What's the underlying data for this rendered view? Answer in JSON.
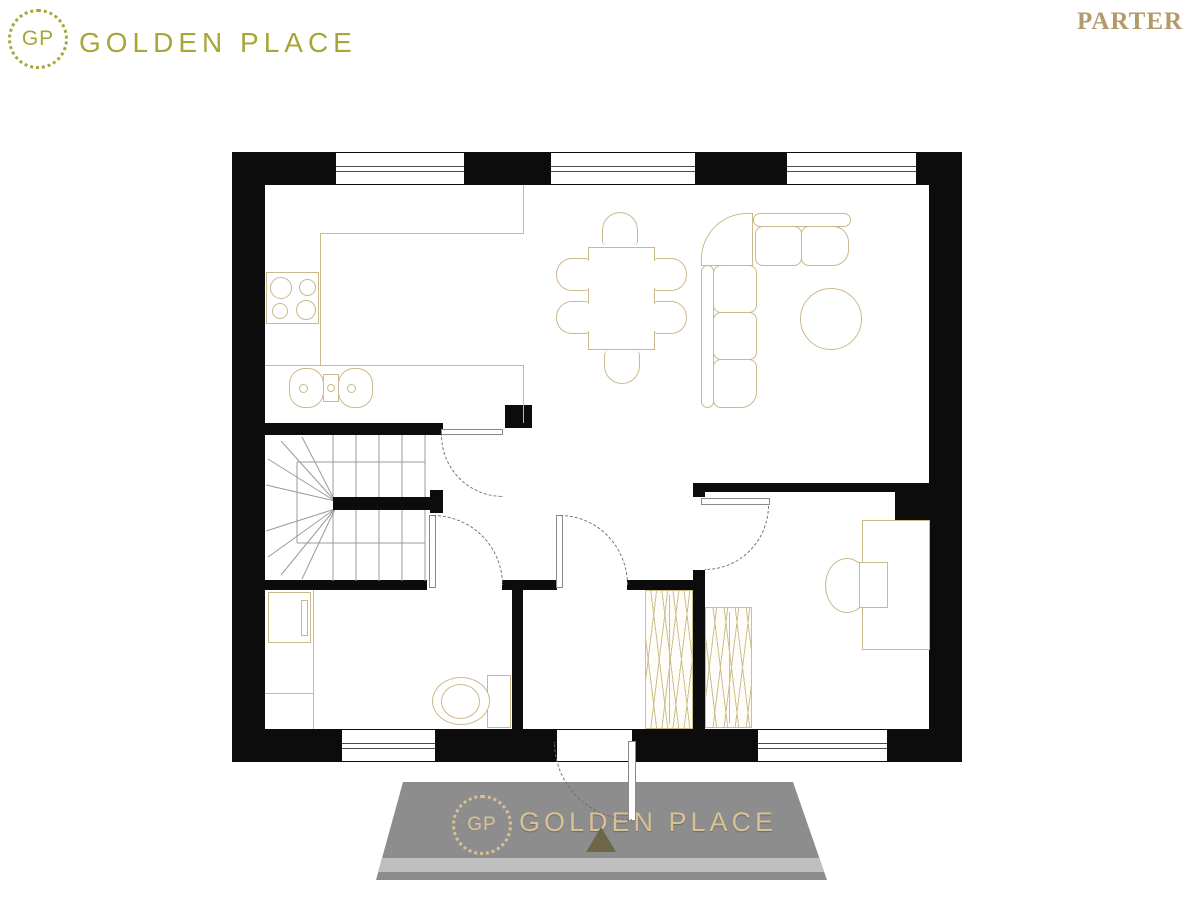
{
  "header": {
    "logo_initials": "GP",
    "logo_text": "GOLDEN PLACE",
    "plan_label": "PARTER"
  },
  "watermark": {
    "logo_initials": "GP",
    "logo_text": "GOLDEN PLACE"
  },
  "colors": {
    "wall": "#0c0c0c",
    "brand_olive": "#a8a637",
    "floor_label_gold": "#b39a68",
    "furniture_outline": "#c9b98c",
    "watermark_gold": "#d9c196",
    "podium_gray": "#8d8d8d"
  }
}
